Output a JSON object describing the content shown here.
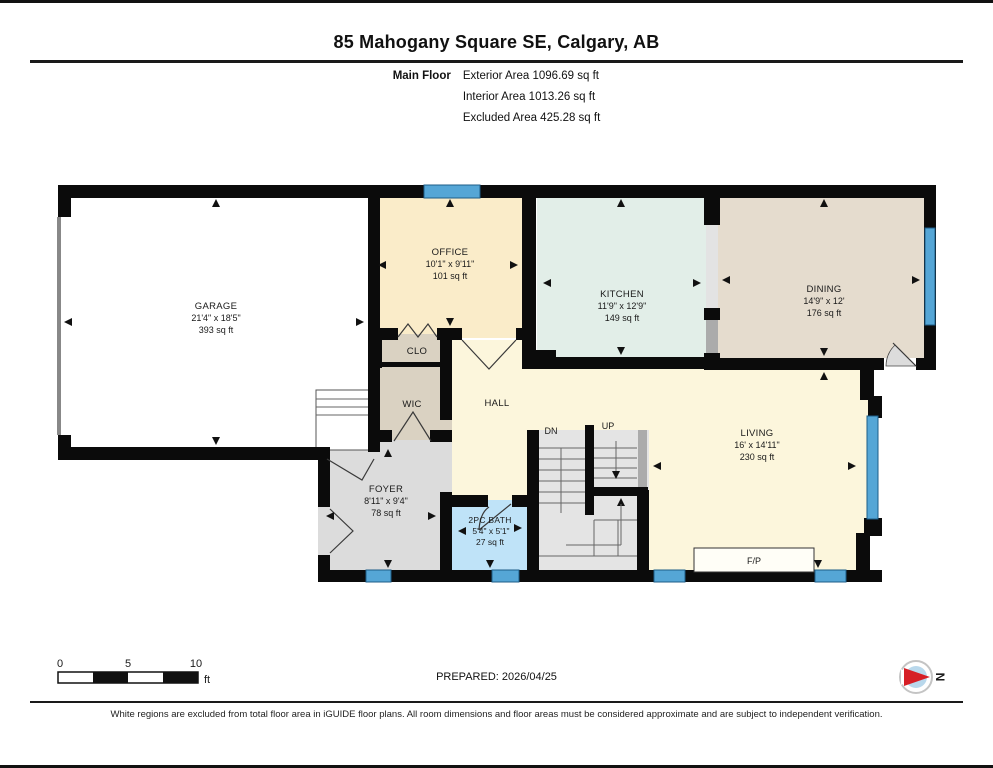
{
  "page": {
    "title": "85 Mahogany Square SE, Calgary, AB",
    "floor_label": "Main Floor",
    "areas": {
      "exterior": "Exterior Area 1096.69 sq ft",
      "interior": "Interior Area 1013.26 sq ft",
      "excluded": "Excluded Area 425.28 sq ft"
    }
  },
  "rooms": {
    "garage": {
      "name": "GARAGE",
      "dims": "21'4\" x 18'5\"",
      "area": "393 sq ft"
    },
    "office": {
      "name": "OFFICE",
      "dims": "10'1\" x 9'11\"",
      "area": "101 sq ft"
    },
    "kitchen": {
      "name": "KITCHEN",
      "dims": "11'9\" x 12'9\"",
      "area": "149 sq ft"
    },
    "dining": {
      "name": "DINING",
      "dims": "14'9\" x 12'",
      "area": "176 sq ft"
    },
    "living": {
      "name": "LIVING",
      "dims": "16' x 14'11\"",
      "area": "230 sq ft"
    },
    "foyer": {
      "name": "FOYER",
      "dims": "8'11\" x 9'4\"",
      "area": "78 sq ft"
    },
    "bath": {
      "name": "2PC BATH",
      "dims": "5'4\" x 5'1\"",
      "area": "27 sq ft"
    },
    "hall": {
      "name": "HALL"
    },
    "clo": {
      "name": "CLO"
    },
    "wic": {
      "name": "WIC"
    },
    "stairs_dn": "DN",
    "stairs_up": "UP",
    "fireplace": "F/P"
  },
  "scale_bar": {
    "t0": "0",
    "t5": "5",
    "t10": "10",
    "unit": "ft"
  },
  "compass": {
    "label": "N"
  },
  "footer": {
    "prepared": "PREPARED: 2026/04/25",
    "disclaimer": "White regions are excluded from total floor area in iGUIDE floor plans. All room dimensions and floor areas must be considered approximate and are subject to independent verification."
  },
  "colors": {
    "wall": "#0b0b0b",
    "window_blue": "#55a6d6",
    "office_fill": "#faecc9",
    "kitchen_fill": "#e2eee8",
    "dining_fill": "#e5dcce",
    "hall_living_fill": "#fcf6dc",
    "foyer_fill": "#dcdcdc",
    "closet_fill": "#dad2c2",
    "bath_fill": "#bfe3f8",
    "stairs_fill": "#e4e4e4",
    "compass_red": "#d61f26"
  }
}
